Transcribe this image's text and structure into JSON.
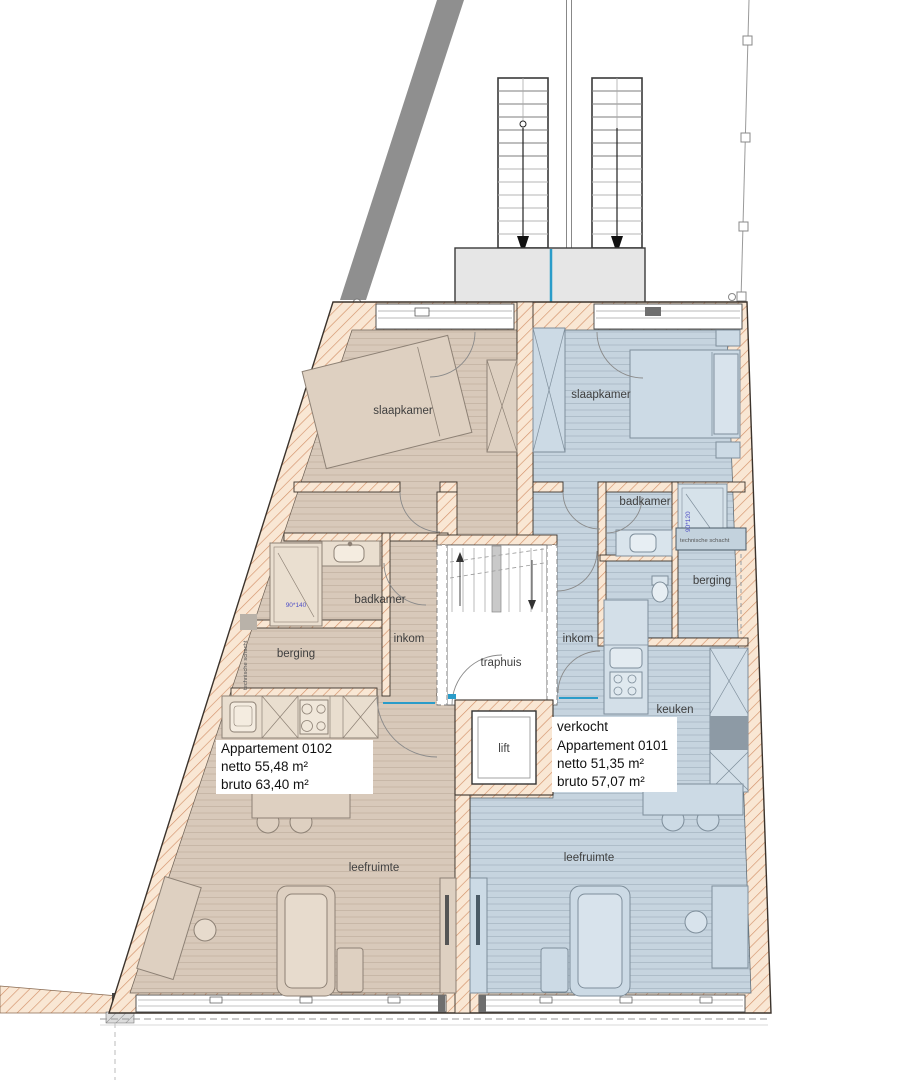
{
  "plan": {
    "core": {
      "traphuis_label": "traphuis",
      "lift_label": "lift"
    },
    "apartment_0102": {
      "name": "Appartement 0102",
      "netto": "netto 55,48 m²",
      "bruto": "bruto 63,40 m²",
      "rooms": {
        "slaapkamer": "slaapkamer",
        "badkamer": "badkamer",
        "berging": "berging",
        "inkom": "inkom",
        "leefruimte": "leefruimte"
      },
      "shower_dim": "90*140",
      "shaft_label": "technische schacht"
    },
    "apartment_0101": {
      "status": "verkocht",
      "name": "Appartement 0101",
      "netto": "netto 51,35 m²",
      "bruto": "bruto 57,07 m²",
      "rooms": {
        "slaapkamer": "slaapkamer",
        "badkamer": "badkamer",
        "berging": "berging",
        "inkom": "inkom",
        "keuken": "keuken",
        "leefruimte": "leefruimte"
      },
      "shower_dim": "90*120",
      "shaft_label": "technische schacht"
    },
    "colors": {
      "apartment_0102_floor": "#d8c9ba",
      "apartment_0101_floor": "#c6d4df",
      "wall_fill": "#f9e7d4",
      "wall_hatch_line": "#d3926a",
      "landing_gray": "#e6e6e6",
      "boundary_band_gray": "#8f8f8f",
      "divider_blue": "#2a9cc9",
      "dim_text_blue": "#5151c6"
    }
  }
}
